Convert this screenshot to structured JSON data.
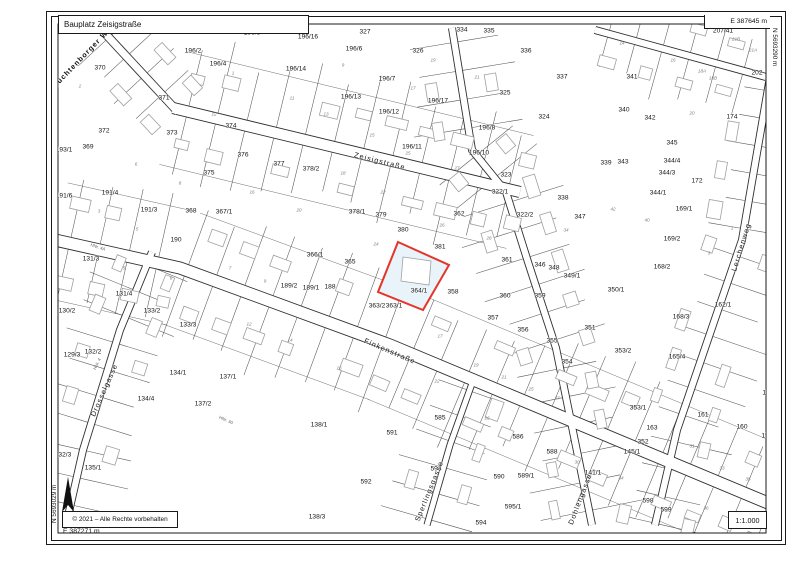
{
  "header": {
    "title": "Bauplatz Zeisigstraße",
    "coord_top_right": "E 387645 m",
    "coord_right_vertical": "N 5693290 m"
  },
  "footer": {
    "copyright": "© 2021 – Alle Rechte vorbehalten",
    "coord_bottom_left": "E 387271 m",
    "coord_left_vertical": "N 5693029 m",
    "scale": "1:1.000"
  },
  "map": {
    "colors": {
      "line": "#2f2f2f",
      "tick": "#555555",
      "building": "#a0a0a0",
      "backline": "#6f6f6f",
      "highlight_stroke": "#e5342a",
      "highlight_fill": "#e9f4fa",
      "north_arrow": "#111111"
    },
    "highlight": {
      "label": "364/1",
      "polygon": [
        [
          398,
          242
        ],
        [
          449,
          265
        ],
        [
          423,
          310
        ],
        [
          378,
          292
        ]
      ],
      "building": [
        [
          403,
          257
        ],
        [
          431,
          261
        ],
        [
          429,
          285
        ],
        [
          401,
          281
        ]
      ]
    },
    "streets": [
      {
        "name": "Zeisigstraße",
        "path": [
          [
            173,
            108
          ],
          [
            520,
            192
          ]
        ],
        "w": 12,
        "label": {
          "t": "Zeisigstraße",
          "x": 380,
          "y": 161,
          "r": 14
        },
        "ticks": [
          62,
          55
        ],
        "tsp": 30,
        "bld": {
          "sp": 34,
          "off": 26
        }
      },
      {
        "name": "Finkenstraße",
        "path": [
          [
            55,
            240
          ],
          [
            180,
            268
          ],
          [
            390,
            345
          ],
          [
            780,
            508
          ]
        ],
        "w": 13,
        "label": {
          "t": "Finkenstraße",
          "x": 390,
          "y": 351,
          "r": 23
        },
        "ticks": [
          60,
          58
        ],
        "tsp": 30,
        "bld": {
          "sp": 34,
          "off": 28
        }
      },
      {
        "name": "Lüchtenborger Weg",
        "path": [
          [
            100,
            28
          ],
          [
            178,
            112
          ]
        ],
        "w": 9,
        "label": {
          "t": "Lüchtenborger Weg",
          "x": 84,
          "y": 55,
          "r": -46,
          "bold": true
        },
        "ticks": [
          35,
          30
        ],
        "tsp": 26,
        "bld": {
          "sp": 42,
          "off": 22
        }
      },
      {
        "name": "Lerchenweg",
        "path": [
          [
            770,
            77
          ],
          [
            742,
            240
          ],
          [
            677,
            430
          ],
          [
            655,
            525
          ]
        ],
        "w": 8,
        "label": {
          "t": "Lerchenweg",
          "x": 741,
          "y": 247,
          "r": -73
        },
        "ticks": [
          48,
          26
        ],
        "tsp": 28,
        "bld": {
          "sp": 40,
          "off": 22
        }
      },
      {
        "name": "Drosselgasse",
        "path": [
          [
            152,
            252
          ],
          [
            120,
            330
          ],
          [
            83,
            450
          ],
          [
            66,
            525
          ]
        ],
        "w": 8,
        "label": {
          "t": "Drosselgasse",
          "x": 104,
          "y": 390,
          "r": -66
        },
        "ticks": [
          40,
          40
        ],
        "tsp": 28,
        "bld": {
          "sp": 46,
          "off": 20
        }
      },
      {
        "name": "Sperlingsgasse",
        "path": [
          [
            474,
            378
          ],
          [
            450,
            445
          ],
          [
            427,
            525
          ]
        ],
        "w": 7,
        "label": {
          "t": "Sperlingsgasse",
          "x": 429,
          "y": 491,
          "r": -68
        },
        "ticks": [
          38,
          38
        ],
        "tsp": 27,
        "bld": {
          "sp": 46,
          "off": 20
        }
      },
      {
        "name": "Dohlengasse",
        "path": [
          [
            452,
            28
          ],
          [
            472,
            150
          ],
          [
            506,
            192
          ],
          [
            528,
            262
          ],
          [
            556,
            348
          ],
          [
            592,
            525
          ]
        ],
        "w": 8,
        "label": {
          "t": "Dohlengasse",
          "x": 580,
          "y": 499,
          "r": -69
        },
        "ticks": [
          44,
          44
        ],
        "tsp": 29,
        "bld": {
          "sp": 40,
          "off": 22
        }
      },
      {
        "name": "",
        "path": [
          [
            595,
            30
          ],
          [
            766,
            77
          ]
        ],
        "w": 8,
        "label": null,
        "ticks": [
          26,
          40
        ],
        "tsp": 28,
        "bld": {
          "sp": 40,
          "off": 20
        }
      }
    ],
    "parcels": [
      [
        "370",
        100,
        68
      ],
      [
        "196/2",
        193,
        51
      ],
      [
        "196/5",
        252,
        33
      ],
      [
        "196/16",
        308,
        37
      ],
      [
        "327",
        365,
        32
      ],
      [
        "334",
        462,
        30
      ],
      [
        "335",
        489,
        31
      ],
      [
        "326",
        418,
        51
      ],
      [
        "336",
        526,
        51
      ],
      [
        "196/4",
        218,
        64
      ],
      [
        "196/6",
        354,
        49
      ],
      [
        "196/14",
        296,
        69
      ],
      [
        "196/7",
        387,
        79
      ],
      [
        "196/13",
        351,
        97
      ],
      [
        "196/12",
        389,
        112
      ],
      [
        "371",
        164,
        98
      ],
      [
        "372",
        104,
        131
      ],
      [
        "373",
        172,
        133
      ],
      [
        "374",
        231,
        126
      ],
      [
        "369",
        88,
        147
      ],
      [
        "193/1",
        64,
        150
      ],
      [
        "375",
        209,
        173
      ],
      [
        "376",
        243,
        155
      ],
      [
        "377",
        279,
        164
      ],
      [
        "378/2",
        311,
        169
      ],
      [
        "196/17",
        438,
        101
      ],
      [
        "196/8",
        487,
        128
      ],
      [
        "196/11",
        412,
        147
      ],
      [
        "196/10",
        479,
        153
      ],
      [
        "325",
        505,
        93
      ],
      [
        "324",
        544,
        117
      ],
      [
        "337",
        562,
        77
      ],
      [
        "323",
        506,
        175
      ],
      [
        "322/1",
        500,
        192
      ],
      [
        "322/2",
        525,
        215
      ],
      [
        "338",
        563,
        198
      ],
      [
        "347",
        580,
        217
      ],
      [
        "339",
        606,
        163
      ],
      [
        "343",
        623,
        162
      ],
      [
        "341",
        632,
        77
      ],
      [
        "340",
        624,
        110
      ],
      [
        "342",
        650,
        118
      ],
      [
        "345",
        672,
        143
      ],
      [
        "174",
        732,
        117
      ],
      [
        "207/41",
        723,
        31
      ],
      [
        "202",
        757,
        73
      ],
      [
        "172",
        697,
        181
      ],
      [
        "344/4",
        672,
        161
      ],
      [
        "344/3",
        667,
        173
      ],
      [
        "344/1",
        658,
        193
      ],
      [
        "169/1",
        684,
        209
      ],
      [
        "169/2",
        672,
        239
      ],
      [
        "168/2",
        662,
        267
      ],
      [
        "350/1",
        616,
        290
      ],
      [
        "191/6",
        64,
        196
      ],
      [
        "191/4",
        110,
        193
      ],
      [
        "191/3",
        149,
        210
      ],
      [
        "368",
        191,
        211
      ],
      [
        "367/1",
        224,
        212
      ],
      [
        "190",
        176,
        240
      ],
      [
        "131/3",
        91,
        259
      ],
      [
        "131/4",
        124,
        294
      ],
      [
        "130/2",
        67,
        311
      ],
      [
        "133/2",
        152,
        311
      ],
      [
        "133/3",
        188,
        325
      ],
      [
        "129/3",
        72,
        355
      ],
      [
        "132/2",
        93,
        352
      ],
      [
        "134/1",
        178,
        373
      ],
      [
        "134/4",
        146,
        399
      ],
      [
        "132/3",
        63,
        455
      ],
      [
        "135/1",
        93,
        468
      ],
      [
        "378/1",
        357,
        212
      ],
      [
        "379",
        381,
        215
      ],
      [
        "380",
        403,
        230
      ],
      [
        "381",
        440,
        247
      ],
      [
        "362",
        459,
        214
      ],
      [
        "365",
        350,
        262
      ],
      [
        "366/1",
        315,
        255
      ],
      [
        "189/2",
        289,
        286
      ],
      [
        "189/1",
        311,
        288
      ],
      [
        "188",
        330,
        287
      ],
      [
        "364/1",
        419,
        291
      ],
      [
        "358",
        453,
        292
      ],
      [
        "363/2",
        377,
        306
      ],
      [
        "363/1",
        394,
        306
      ],
      [
        "361",
        507,
        260
      ],
      [
        "346",
        540,
        265
      ],
      [
        "348",
        554,
        268
      ],
      [
        "349/1",
        572,
        276
      ],
      [
        "360",
        505,
        296
      ],
      [
        "359",
        540,
        296
      ],
      [
        "357",
        493,
        318
      ],
      [
        "356",
        523,
        330
      ],
      [
        "355",
        552,
        341
      ],
      [
        "351",
        590,
        328
      ],
      [
        "354",
        567,
        362
      ],
      [
        "162/1",
        723,
        305
      ],
      [
        "168/3",
        681,
        317
      ],
      [
        "353/2",
        623,
        351
      ],
      [
        "165/4",
        677,
        357
      ],
      [
        "353/1",
        638,
        408
      ],
      [
        "163",
        652,
        428
      ],
      [
        "352",
        643,
        442
      ],
      [
        "161",
        703,
        415
      ],
      [
        "160",
        742,
        427
      ],
      [
        "15",
        766,
        393
      ],
      [
        "15",
        765,
        436
      ],
      [
        "137/1",
        228,
        377
      ],
      [
        "137/2",
        203,
        404
      ],
      [
        "138/1",
        319,
        425
      ],
      [
        "591",
        392,
        433
      ],
      [
        "585",
        440,
        418
      ],
      [
        "586",
        518,
        437
      ],
      [
        "138/3",
        317,
        517
      ],
      [
        "592",
        366,
        482
      ],
      [
        "593",
        436,
        469
      ],
      [
        "590",
        499,
        477
      ],
      [
        "589/1",
        526,
        476
      ],
      [
        "588",
        552,
        452
      ],
      [
        "595/1",
        513,
        507
      ],
      [
        "594",
        481,
        523
      ],
      [
        "141/1",
        593,
        473
      ],
      [
        "145/1",
        632,
        452
      ],
      [
        "598",
        648,
        501
      ],
      [
        "599",
        666,
        510
      ]
    ],
    "house_numbers": [
      [
        "2",
        80,
        86
      ],
      [
        "1",
        233,
        73
      ],
      [
        "9",
        343,
        65
      ],
      [
        "11",
        292,
        98
      ],
      [
        "13",
        326,
        114
      ],
      [
        "15",
        372,
        135
      ],
      [
        "12",
        214,
        114
      ],
      [
        "17",
        413,
        88
      ],
      [
        "19",
        433,
        60
      ],
      [
        "21",
        477,
        77
      ],
      [
        "14",
        622,
        43
      ],
      [
        "16",
        673,
        60
      ],
      [
        "18A",
        702,
        71
      ],
      [
        "18B",
        713,
        78
      ],
      [
        "20",
        692,
        113
      ],
      [
        "21B",
        736,
        39
      ],
      [
        "21A",
        753,
        50
      ],
      [
        "42",
        613,
        209
      ],
      [
        "40",
        647,
        220
      ],
      [
        "1",
        732,
        228
      ],
      [
        "3",
        709,
        253
      ],
      [
        "6",
        136,
        164
      ],
      [
        "8",
        180,
        183
      ],
      [
        "3",
        99,
        211
      ],
      [
        "5",
        137,
        229
      ],
      [
        "5",
        124,
        268
      ],
      [
        "6",
        171,
        278
      ],
      [
        "16",
        252,
        192
      ],
      [
        "18",
        343,
        173
      ],
      [
        "20",
        299,
        210
      ],
      [
        "22",
        383,
        192
      ],
      [
        "24",
        376,
        244
      ],
      [
        "7",
        230,
        268
      ],
      [
        "9",
        265,
        281
      ],
      [
        "25",
        408,
        153
      ],
      [
        "27",
        457,
        168
      ],
      [
        "26",
        442,
        225
      ],
      [
        "28",
        489,
        238
      ],
      [
        "34",
        566,
        230
      ],
      [
        "12",
        249,
        324
      ],
      [
        "14",
        290,
        340
      ],
      [
        "16",
        339,
        368
      ],
      [
        "17",
        440,
        336
      ],
      [
        "19",
        476,
        365
      ],
      [
        "21",
        504,
        377
      ],
      [
        "25",
        531,
        389
      ],
      [
        "27",
        557,
        398
      ],
      [
        "22",
        437,
        381
      ],
      [
        "26",
        487,
        418
      ],
      [
        "31",
        692,
        446
      ],
      [
        "33",
        722,
        468
      ],
      [
        "35",
        748,
        479
      ],
      [
        "34",
        621,
        478
      ],
      [
        "36",
        706,
        508
      ],
      [
        "30",
        577,
        462
      ]
    ],
    "misc_labels": [
      {
        "t": "HNr. 4A",
        "x": 98,
        "y": 247,
        "r": 18
      },
      {
        "t": "HNr. 30",
        "x": 226,
        "y": 420,
        "r": 24
      },
      {
        "t": "HNr. 4",
        "x": 97,
        "y": 364,
        "r": -65
      }
    ]
  }
}
